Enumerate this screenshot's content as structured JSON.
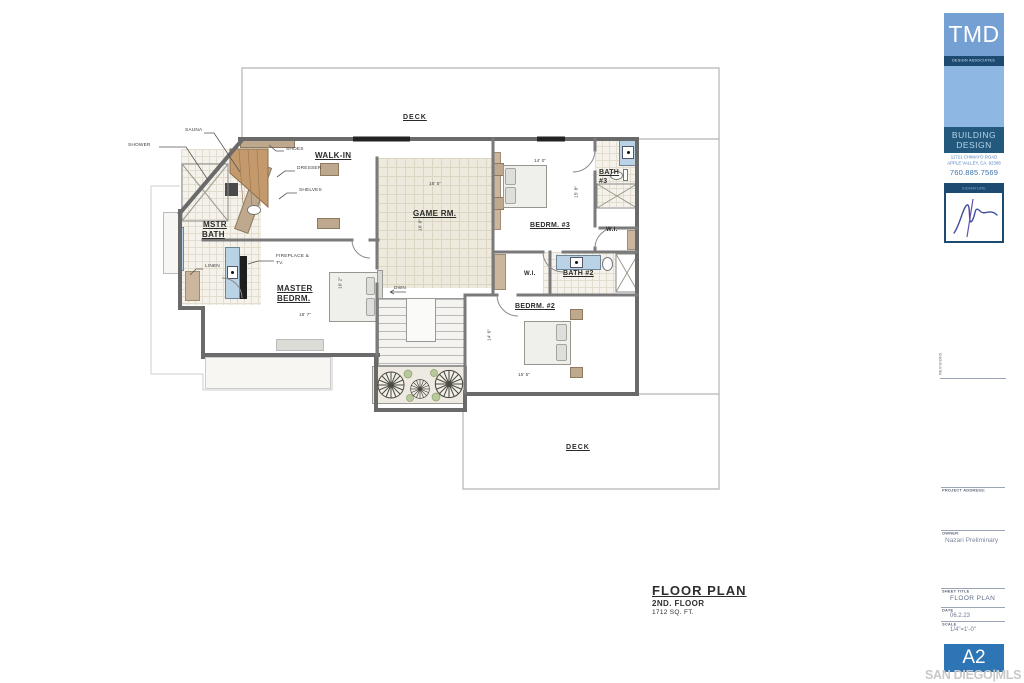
{
  "plan_title": {
    "title": "FLOOR PLAN",
    "subtitle": "2ND. FLOOR",
    "area": "1712 SQ. FT."
  },
  "rooms": {
    "deck_top": "DECK",
    "deck_bottom": "DECK",
    "walk_in": "WALK-IN",
    "mstr_bath_line1": "MSTR",
    "mstr_bath_line2": "BATH",
    "master_bedrm_line1": "MASTER",
    "master_bedrm_line2": "BEDRM.",
    "game_rm": "GAME RM.",
    "bedrm_3": "BEDRM. #3",
    "bath_3_line1": "BATH",
    "bath_3_line2": "#3",
    "bath_2": "BATH #2",
    "bedrm_2": "BEDRM. #2",
    "wi_3": "W.I.",
    "wi_2": "W.I."
  },
  "annotations": {
    "shower": "SHOWER",
    "sauna": "SAUNA",
    "shoes": "SHOES",
    "dresser": "DRESSER",
    "shelves": "SHELVES",
    "linen": "LINEN",
    "fireplace_line1": "FIREPLACE &",
    "fireplace_line2": "TV.",
    "down": "DWN"
  },
  "dimensions": {
    "game_w": "16' 5\"",
    "game_h": "16' 8\"",
    "bedrm3_w": "14' 0\"",
    "bedrm3_h": "15' 8\"",
    "bedrm2_w": "15' 5\"",
    "bedrm2_h": "14' 6\"",
    "master_w": "18' 7\"",
    "master_h": "16' 2\""
  },
  "title_block": {
    "logo_acronym": "TMD",
    "logo_subtitle": "DESIGN ASSOCIATES",
    "firm_line1": "BUILDING",
    "firm_line2": "DESIGN",
    "address_line1": "11721 CHIMAYO ROAD",
    "address_line2": "APPLE VALLEY, CA. 92308",
    "phone": "760.885.7569",
    "signature_label": "SIGNATURE",
    "revisions_label": "REVISIONS",
    "project_address_label": "PROJECT ADDRESS:",
    "owner_label": "OWNER:",
    "owner_value": "Nazari Preliminary",
    "sheet_title_label": "SHEET TITLE",
    "sheet_title_value": "FLOOR PLAN",
    "date_label": "DATE",
    "date_value": "06.2.23",
    "scale_label": "SCALE",
    "scale_value": "1/4\"=1'-0\"",
    "sheet_number": "A2",
    "watermark": "SAN DIEGO|MLS"
  },
  "colors": {
    "brand_blue_top": "#74a0d3",
    "brand_blue_light": "#8fb7e3",
    "brand_blue_dark": "#1d4a70",
    "building_band_blue": "#23597c",
    "sheet_number_blue": "#2e75b6",
    "fixture_blue": "#b9d2e6",
    "wood_tan": "#c49a6c",
    "cabinet_tan": "#bfa98e",
    "wall_gray": "#6a6a6a",
    "watermark_gray": "#c8c8c8"
  }
}
